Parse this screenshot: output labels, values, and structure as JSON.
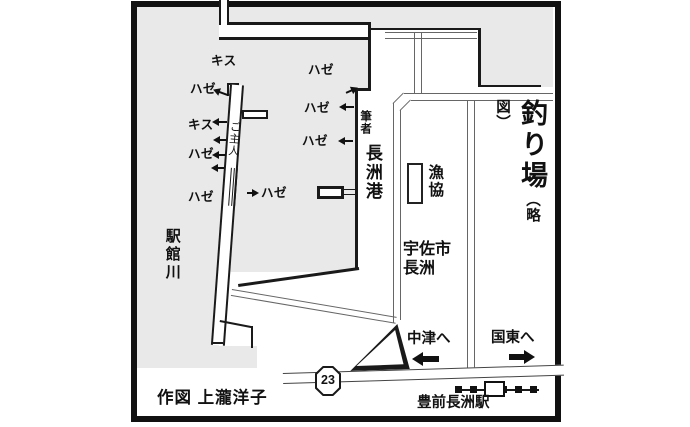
{
  "title": {
    "main": "釣り場",
    "sub": "（略図）"
  },
  "credit": "作図 上瀧洋子",
  "labels": {
    "river": "駅館川",
    "port": "長洲港",
    "author": "筆者",
    "husband": "ご主人",
    "coop": "漁協",
    "city_line1": "宇佐市",
    "city_line2": "長洲",
    "station": "豊前長洲駅",
    "to_nakatsu": "中津へ",
    "to_kunisaki": "国東へ",
    "route_number": "23"
  },
  "spots": [
    "キス",
    "ハゼ",
    "キス",
    "ハゼ",
    "ハゼ",
    "ハゼ",
    "ハゼ",
    "ハゼ",
    "ハゼ"
  ]
}
